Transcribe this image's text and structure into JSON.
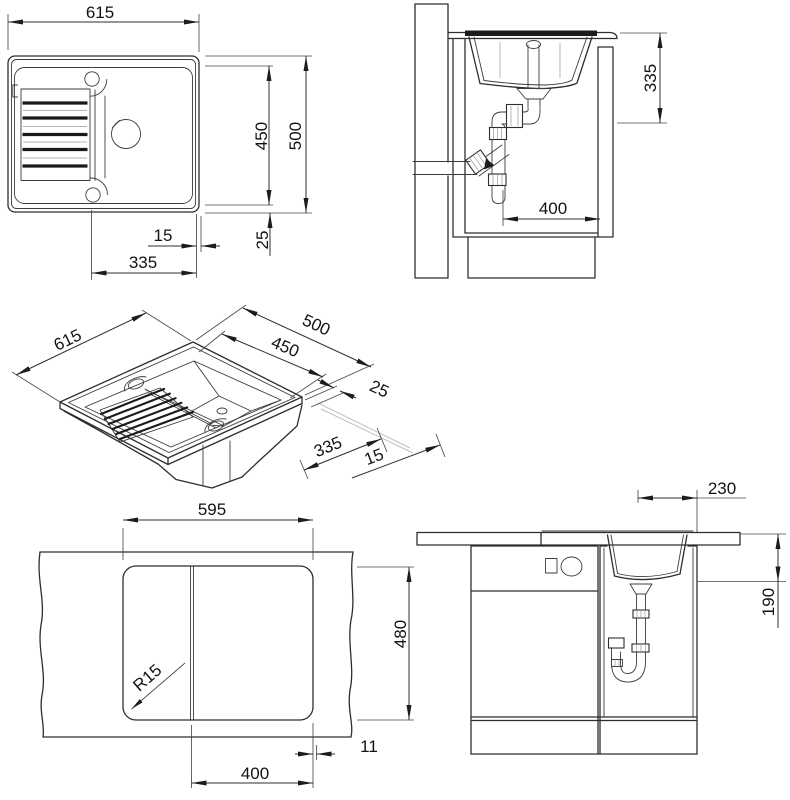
{
  "views": {
    "plan": {
      "width": "615",
      "inner_depth": "450",
      "outer_depth": "500",
      "rim": "15",
      "edge": "25",
      "offset": "335"
    },
    "side": {
      "drain_height": "335",
      "clearance": "400"
    },
    "iso": {
      "width": "615",
      "outer_depth": "500",
      "inner_depth": "450",
      "edge": "25",
      "offset": "335",
      "rim": "15"
    },
    "cutout": {
      "width": "595",
      "height": "480",
      "corner_radius": "R15",
      "edge_gap": "11",
      "offset": "400"
    },
    "front": {
      "bowl_width": "230",
      "bowl_depth": "190"
    }
  }
}
